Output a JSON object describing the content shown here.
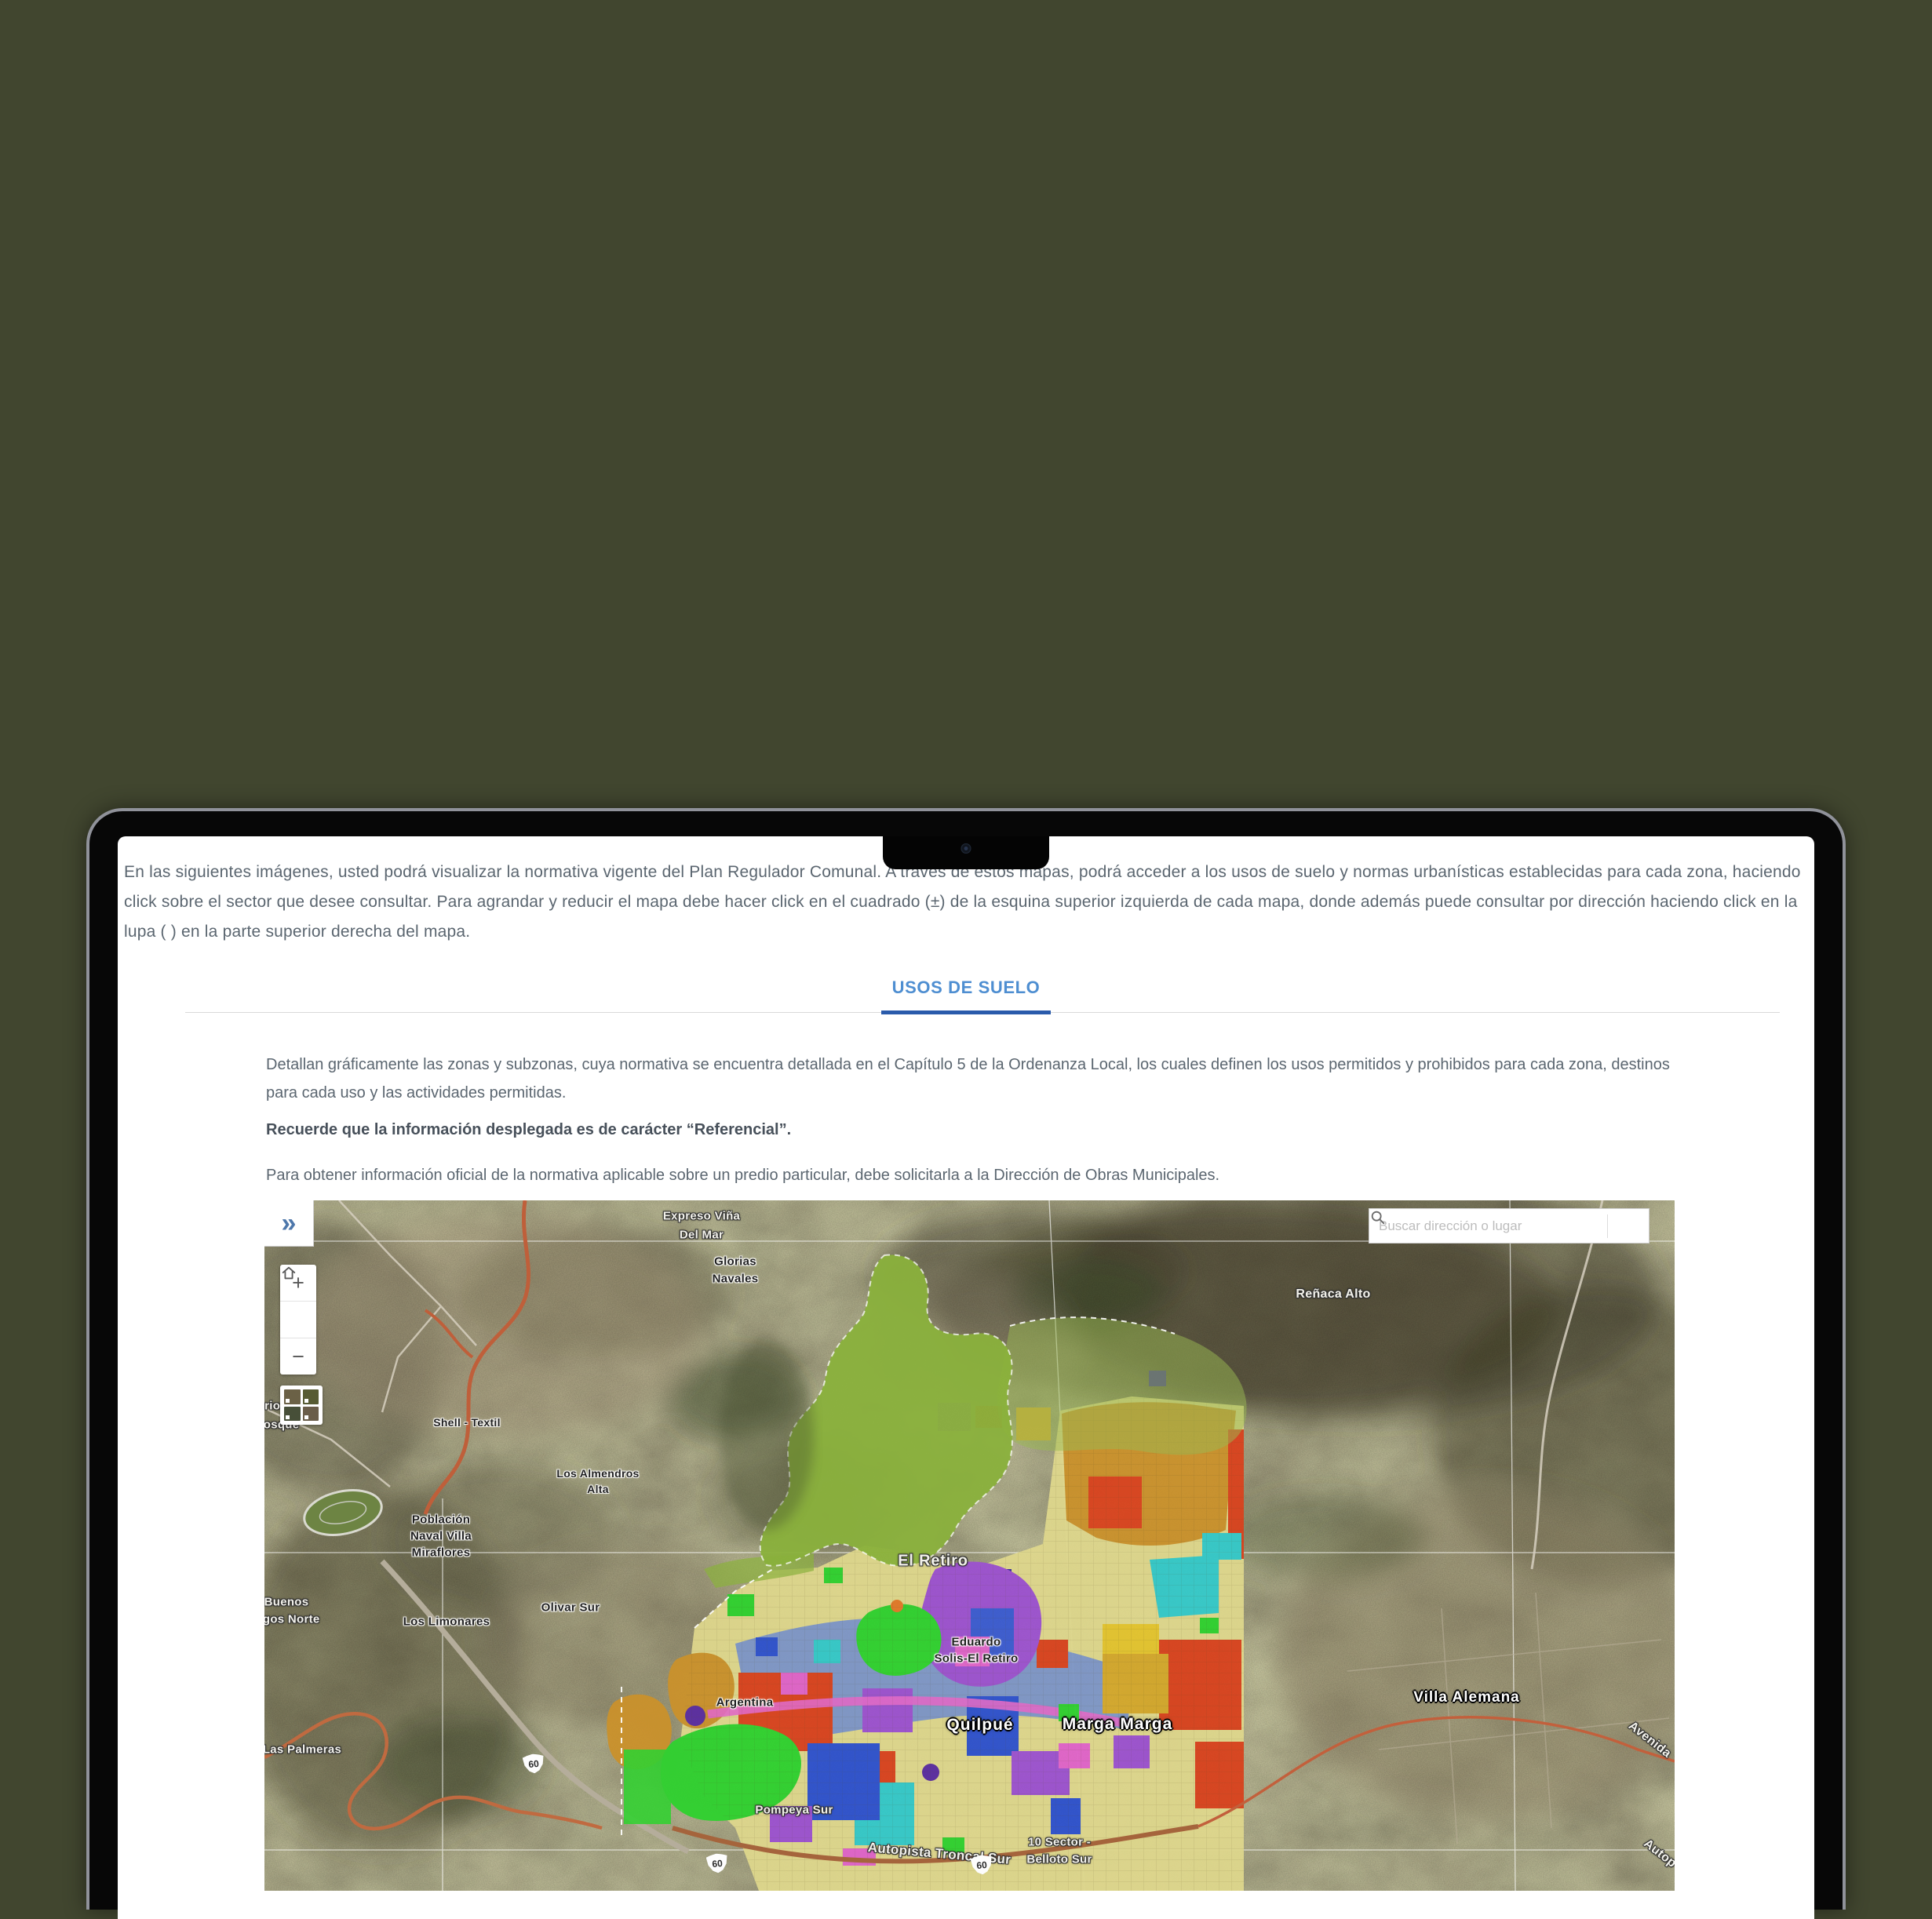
{
  "page": {
    "background": "#41462f"
  },
  "laptop": {
    "camera": "camera"
  },
  "screen": {
    "intro": "En las siguientes imágenes, usted podrá visualizar la normativa vigente del Plan Regulador Comunal. A través de estos mapas, podrá acceder a los usos de suelo y normas urbanísticas establecidas para cada zona, haciendo click sobre el sector que desee consultar. Para agrandar y reducir el mapa debe hacer click en el cuadrado (±) de la esquina superior izquierda de cada mapa, donde además puede consultar por dirección haciendo click en la lupa ( ) en la parte superior derecha del mapa.",
    "tab": {
      "label": "USOS DE SUELO"
    },
    "section": {
      "p1": "Detallan gráficamente las zonas y subzonas, cuya normativa se encuentra detallada en el Capítulo 5 de la Ordenanza Local, los cuales definen los usos permitidos y prohibidos para cada zona, destinos para cada uso y las actividades permitidas.",
      "p2": "Recuerde que la información desplegada es de carácter “Referencial”.",
      "p3": "Para obtener información oficial de la normativa aplicable sobre un predio particular, debe solicitarla a la Dirección de Obras Municipales."
    },
    "map": {
      "search": {
        "placeholder": "Buscar dirección o lugar"
      },
      "controls": {
        "expand": "»",
        "zoom_in": "+",
        "zoom_out": "−"
      },
      "labels": [
        {
          "text": "Expreso Viña"
        },
        {
          "text": "Del Mar"
        },
        {
          "text": "Glorias"
        },
        {
          "text": "Navales"
        },
        {
          "text": "Reñaca Alto"
        },
        {
          "text": "Shell - Textil"
        },
        {
          "text": "Lirios - El"
        },
        {
          "text": "Bosque"
        },
        {
          "text": "Los Almendros"
        },
        {
          "text": "Alta"
        },
        {
          "text": "Población"
        },
        {
          "text": "Naval Villa"
        },
        {
          "text": "Miraflores"
        },
        {
          "text": "Buenos"
        },
        {
          "text": "igos Norte"
        },
        {
          "text": "Los Limonares"
        },
        {
          "text": "Olivar Sur"
        },
        {
          "text": "Las Palmeras"
        },
        {
          "text": "El Retiro"
        },
        {
          "text": "Eduardo"
        },
        {
          "text": "Solis-El Retiro"
        },
        {
          "text": "Argentina"
        },
        {
          "text": "Quilpué"
        },
        {
          "text": "Marga Marga"
        },
        {
          "text": "Pompeya Sur"
        },
        {
          "text": "Autopista Troncal Sur"
        },
        {
          "text": "10 Sector -"
        },
        {
          "text": "Belloto Sur"
        },
        {
          "text": "Villa Alemana"
        },
        {
          "text": "Avenida"
        },
        {
          "text": "Autop"
        }
      ],
      "shields": [
        {
          "label": "60"
        },
        {
          "label": "60"
        },
        {
          "label": "60"
        }
      ],
      "palette": {
        "tab_blue": "#4e8ed1",
        "tab_underline": "#2a5bab",
        "body_text": "#5b6670",
        "zone_khaki": "#ddd68c",
        "zone_red": "#d8431f",
        "zone_purple": "#9c52cf",
        "zone_green": "#2fd12f",
        "zone_lime": "#8ab13c",
        "zone_cyan": "#35c8c8",
        "zone_blue": "#2e52cc",
        "zone_bluegray": "#7e96c6",
        "zone_ochre": "#c9912c",
        "zone_magenta": "#df63c8",
        "zone_yellow": "#e2c32e"
      }
    }
  }
}
